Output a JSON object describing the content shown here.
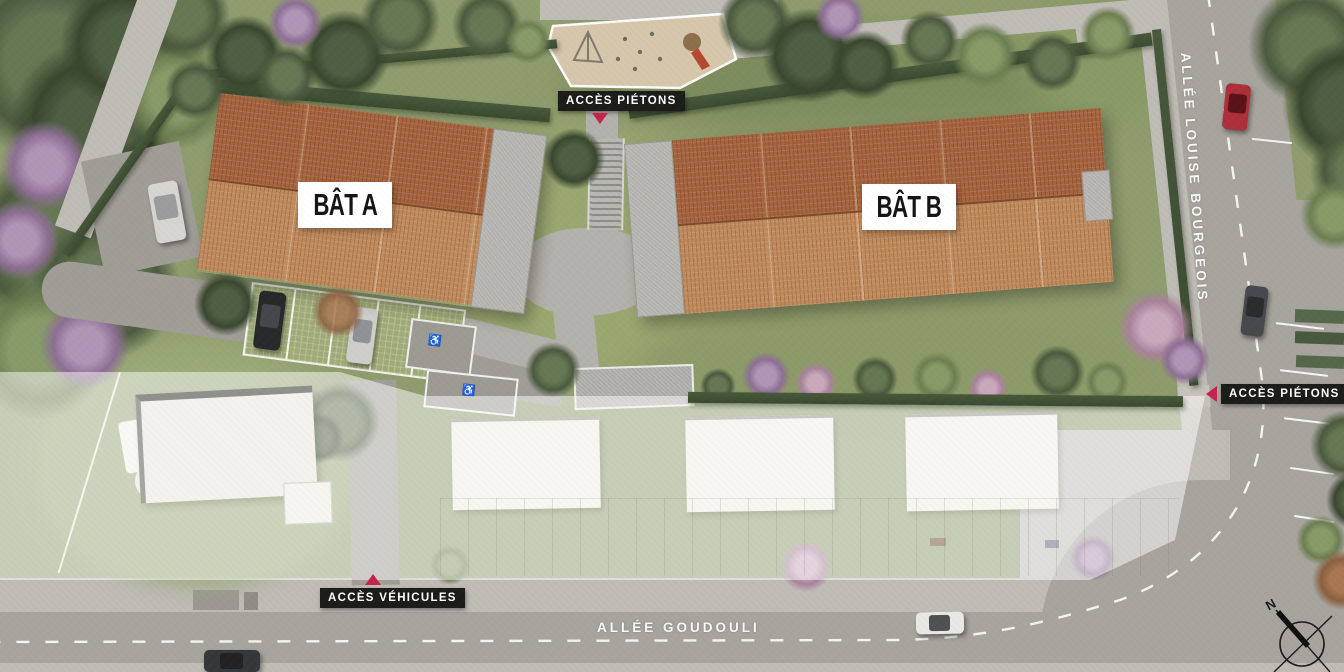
{
  "plan": {
    "buildings": [
      {
        "id": "bat-a",
        "label": "BÂT A"
      },
      {
        "id": "bat-b",
        "label": "BÂT B"
      }
    ],
    "access_markers": [
      {
        "id": "pietons-top",
        "label": "ACCÈS PIÉTONS",
        "direction": "down"
      },
      {
        "id": "pietons-right",
        "label": "ACCÈS PIÉTONS",
        "direction": "left"
      },
      {
        "id": "vehicules-bottom",
        "label": "ACCÈS VÉHICULES",
        "direction": "up"
      }
    ],
    "streets": [
      {
        "id": "allee-louise-bourgeois",
        "label": "ALLÉE LOUISE BOURGEOIS",
        "orientation": "vertical"
      },
      {
        "id": "allee-goudouli",
        "label": "ALLÉE GOUDOULI",
        "orientation": "horizontal"
      }
    ],
    "compass": {
      "label": "N"
    },
    "symbols": {
      "wheelchair": "♿"
    },
    "colors": {
      "marker_red": "#c5234b",
      "label_bg": "#1c1c1a",
      "label_text": "#ffffff",
      "roof_dark": "#a5643d",
      "roof_light": "#c08a5c",
      "flat_roof_gray": "#b4b2ae",
      "grass": "#8f9c6e",
      "hedge": "#3f5133",
      "road": "#a7a49e",
      "sidewalk": "#bfbcb6",
      "playground_sand": "#d9c8ae",
      "faded_parcel": "#f6f5f0"
    }
  }
}
